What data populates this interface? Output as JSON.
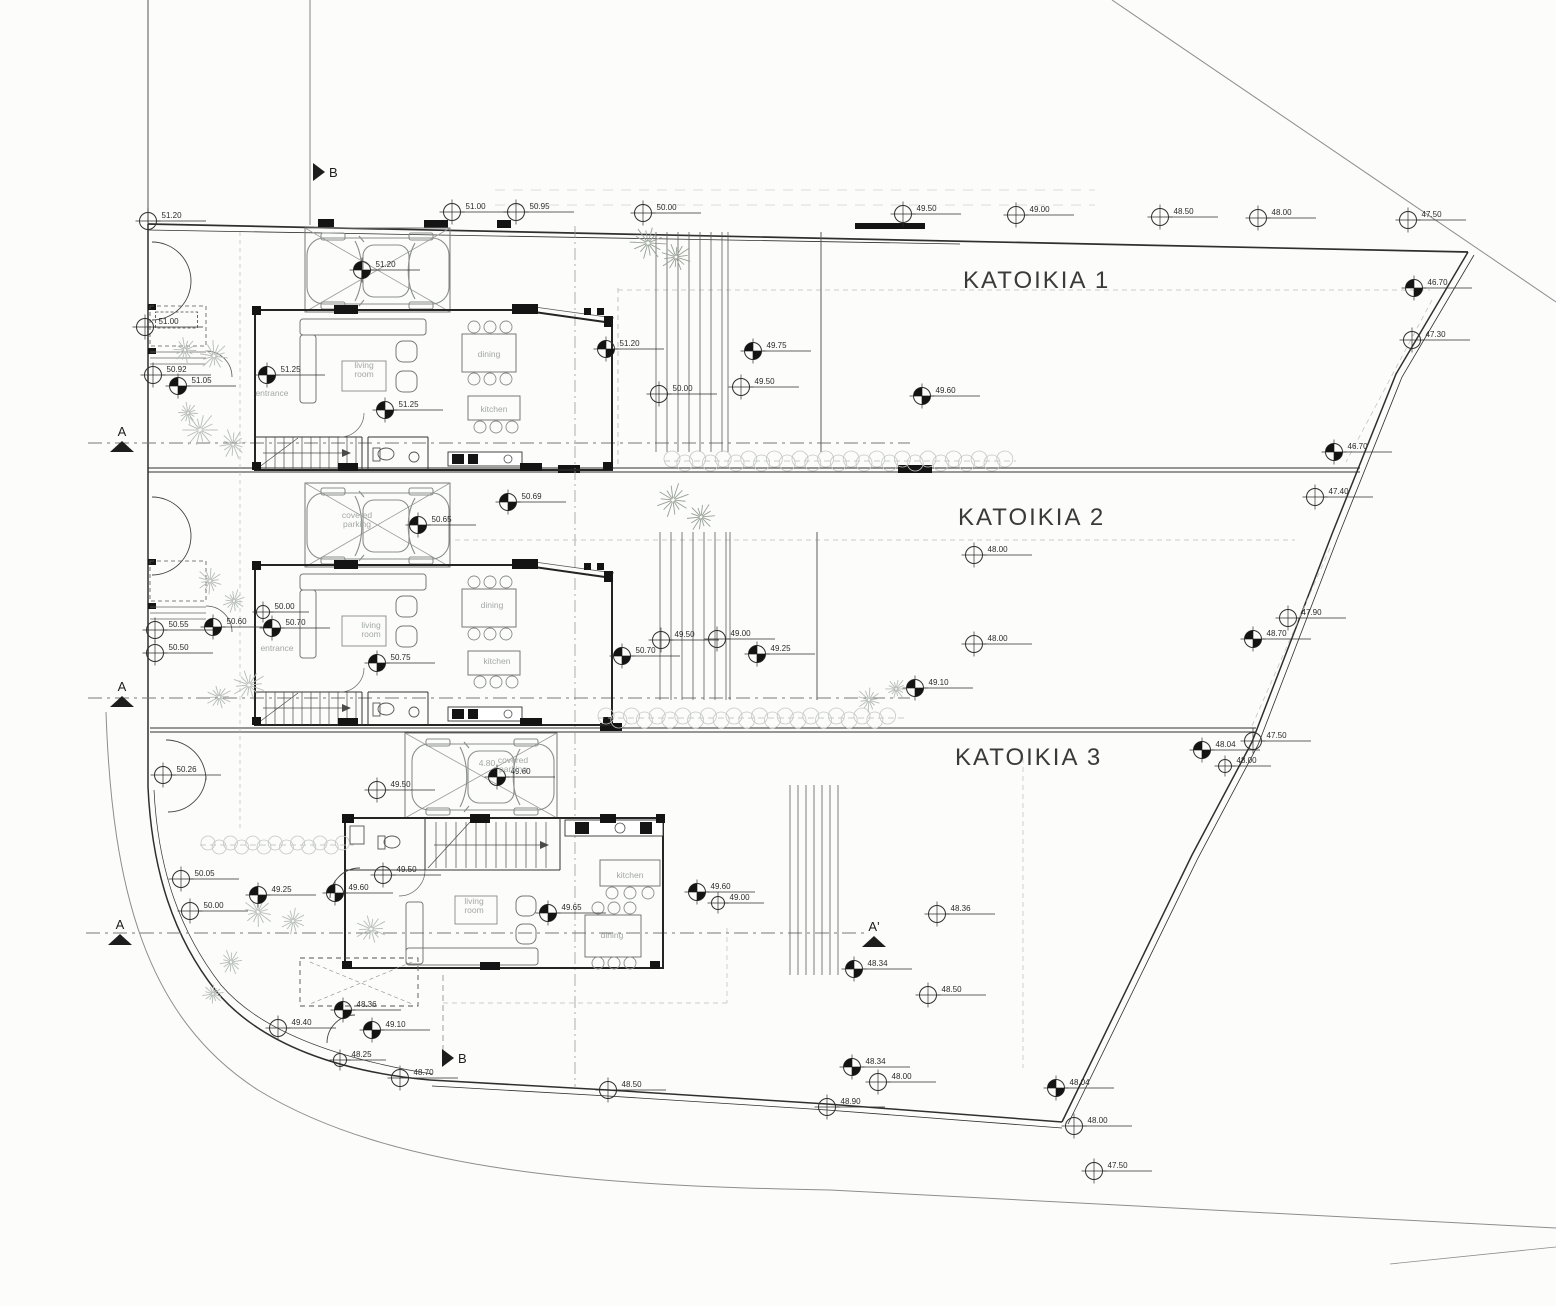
{
  "drawing": {
    "titles": [
      {
        "text": "KATOIKIA 1",
        "x": 963,
        "y": 288
      },
      {
        "text": "KATOIKIA 2",
        "x": 958,
        "y": 525
      },
      {
        "text": "KATOIKIA 3",
        "x": 955,
        "y": 765
      }
    ],
    "section_markers": [
      {
        "label": "B",
        "x": 313,
        "y": 172,
        "dir": "r"
      },
      {
        "label": "B",
        "x": 442,
        "y": 1058,
        "dir": "r"
      },
      {
        "label": "A",
        "x": 122,
        "y": 447,
        "dir": "u"
      },
      {
        "label": "A",
        "x": 122,
        "y": 702,
        "dir": "u"
      },
      {
        "label": "A",
        "x": 120,
        "y": 940,
        "dir": "u"
      },
      {
        "label": "A'",
        "x": 874,
        "y": 942,
        "dir": "u"
      }
    ],
    "room_labels": [
      {
        "t": "living",
        "t2": "room",
        "x": 364,
        "y": 368
      },
      {
        "t": "dining",
        "x": 489,
        "y": 357
      },
      {
        "t": "kitchen",
        "x": 494,
        "y": 412
      },
      {
        "t": "entrance",
        "x": 272,
        "y": 396,
        "size": 7.5
      },
      {
        "t": "covered",
        "t2": "parking",
        "x": 357,
        "y": 518
      },
      {
        "t": "living",
        "t2": "room",
        "x": 371,
        "y": 628
      },
      {
        "t": "dining",
        "x": 492,
        "y": 608
      },
      {
        "t": "kitchen",
        "x": 497,
        "y": 664
      },
      {
        "t": "entrance",
        "x": 277,
        "y": 651,
        "size": 7.5
      },
      {
        "t": "covered",
        "t2": "parking",
        "x": 513,
        "y": 763
      },
      {
        "t": "living",
        "t2": "room",
        "x": 474,
        "y": 904
      },
      {
        "t": "kitchen",
        "x": 630,
        "y": 878
      },
      {
        "t": "dining",
        "x": 612,
        "y": 938
      }
    ],
    "misc_labels": [
      {
        "t": "4.80",
        "x": 487,
        "y": 766,
        "size": 8,
        "dark": 1
      }
    ],
    "elevation_markers": [
      {
        "x": 148,
        "y": 221,
        "v": "51.20"
      },
      {
        "x": 452,
        "y": 212,
        "v": "51.00"
      },
      {
        "x": 516,
        "y": 212,
        "v": "50.95"
      },
      {
        "x": 643,
        "y": 213,
        "v": "50.00"
      },
      {
        "x": 903,
        "y": 214,
        "v": "49.50"
      },
      {
        "x": 1016,
        "y": 215,
        "v": "49.00"
      },
      {
        "x": 1160,
        "y": 217,
        "v": "48.50"
      },
      {
        "x": 1258,
        "y": 218,
        "v": "48.00"
      },
      {
        "x": 1408,
        "y": 220,
        "v": "47.50"
      },
      {
        "x": 1414,
        "y": 288,
        "v": "46.70",
        "h": 1
      },
      {
        "x": 1412,
        "y": 340,
        "v": "47.30"
      },
      {
        "x": 362,
        "y": 270,
        "v": "51.20",
        "h": 1
      },
      {
        "x": 145,
        "y": 327,
        "v": "51.00",
        "box": 1
      },
      {
        "x": 153,
        "y": 375,
        "v": "50.92"
      },
      {
        "x": 178,
        "y": 386,
        "v": "51.05",
        "h": 1
      },
      {
        "x": 267,
        "y": 375,
        "v": "51.25",
        "h": 1
      },
      {
        "x": 385,
        "y": 410,
        "v": "51.25",
        "h": 1
      },
      {
        "x": 606,
        "y": 349,
        "v": "51.20",
        "h": 1
      },
      {
        "x": 753,
        "y": 351,
        "v": "49.75",
        "h": 1
      },
      {
        "x": 741,
        "y": 387,
        "v": "49.50"
      },
      {
        "x": 659,
        "y": 394,
        "v": "50.00"
      },
      {
        "x": 922,
        "y": 396,
        "v": "49.60",
        "h": 1
      },
      {
        "x": 1334,
        "y": 452,
        "v": "46.70",
        "h": 1
      },
      {
        "x": 1315,
        "y": 497,
        "v": "47.40"
      },
      {
        "x": 418,
        "y": 525,
        "v": "50.65",
        "h": 1
      },
      {
        "x": 508,
        "y": 502,
        "v": "50.69",
        "h": 1
      },
      {
        "x": 155,
        "y": 630,
        "v": "50.55"
      },
      {
        "x": 155,
        "y": 653,
        "v": "50.50"
      },
      {
        "x": 213,
        "y": 627,
        "v": "50.60",
        "h": 1
      },
      {
        "x": 263,
        "y": 612,
        "v": "50.00",
        "s": 1
      },
      {
        "x": 272,
        "y": 628,
        "v": "50.70",
        "h": 1
      },
      {
        "x": 377,
        "y": 663,
        "v": "50.75",
        "h": 1
      },
      {
        "x": 622,
        "y": 656,
        "v": "50.70",
        "h": 1
      },
      {
        "x": 661,
        "y": 640,
        "v": "49.50"
      },
      {
        "x": 717,
        "y": 639,
        "v": "49.00"
      },
      {
        "x": 757,
        "y": 654,
        "v": "49.25",
        "h": 1
      },
      {
        "x": 974,
        "y": 555,
        "v": "48.00"
      },
      {
        "x": 974,
        "y": 644,
        "v": "48.00"
      },
      {
        "x": 915,
        "y": 688,
        "v": "49.10",
        "h": 1
      },
      {
        "x": 1288,
        "y": 618,
        "v": "47.90"
      },
      {
        "x": 1253,
        "y": 639,
        "v": "48.70",
        "h": 1
      },
      {
        "x": 1253,
        "y": 741,
        "v": "47.50"
      },
      {
        "x": 1202,
        "y": 750,
        "v": "48.04",
        "h": 1
      },
      {
        "x": 1225,
        "y": 766,
        "v": "48.00",
        "s": 1
      },
      {
        "x": 163,
        "y": 775,
        "v": "50.26"
      },
      {
        "x": 181,
        "y": 879,
        "v": "50.05"
      },
      {
        "x": 190,
        "y": 911,
        "v": "50.00"
      },
      {
        "x": 377,
        "y": 790,
        "v": "49.50"
      },
      {
        "x": 497,
        "y": 777,
        "v": "49.60",
        "h": 1
      },
      {
        "x": 258,
        "y": 895,
        "v": "49.25",
        "h": 1
      },
      {
        "x": 335,
        "y": 893,
        "v": "49.60",
        "h": 1
      },
      {
        "x": 383,
        "y": 875,
        "v": "49.50"
      },
      {
        "x": 548,
        "y": 913,
        "v": "49.65",
        "h": 1
      },
      {
        "x": 697,
        "y": 892,
        "v": "49.60",
        "h": 1
      },
      {
        "x": 718,
        "y": 903,
        "v": "49.00",
        "s": 1
      },
      {
        "x": 937,
        "y": 914,
        "v": "48.36"
      },
      {
        "x": 854,
        "y": 969,
        "v": "48.34",
        "h": 1
      },
      {
        "x": 928,
        "y": 995,
        "v": "48.50"
      },
      {
        "x": 852,
        "y": 1067,
        "v": "48.34",
        "h": 1
      },
      {
        "x": 878,
        "y": 1082,
        "v": "48.00"
      },
      {
        "x": 1056,
        "y": 1088,
        "v": "48.04",
        "h": 1
      },
      {
        "x": 1074,
        "y": 1126,
        "v": "48.00"
      },
      {
        "x": 1094,
        "y": 1171,
        "v": "47.50"
      },
      {
        "x": 343,
        "y": 1010,
        "v": "48.36",
        "h": 1
      },
      {
        "x": 372,
        "y": 1030,
        "v": "49.10",
        "h": 1
      },
      {
        "x": 340,
        "y": 1060,
        "v": "48.25",
        "s": 1
      },
      {
        "x": 400,
        "y": 1078,
        "v": "48.70"
      },
      {
        "x": 608,
        "y": 1090,
        "v": "48.50"
      },
      {
        "x": 827,
        "y": 1107,
        "v": "48.90"
      },
      {
        "x": 278,
        "y": 1028,
        "v": "49.40"
      }
    ],
    "trees": [
      {
        "x": 648,
        "y": 243,
        "r": 20,
        "d": 1
      },
      {
        "x": 676,
        "y": 257,
        "r": 17,
        "d": 1
      },
      {
        "x": 185,
        "y": 350,
        "r": 14
      },
      {
        "x": 214,
        "y": 356,
        "r": 17
      },
      {
        "x": 200,
        "y": 430,
        "r": 21
      },
      {
        "x": 233,
        "y": 444,
        "r": 17
      },
      {
        "x": 188,
        "y": 413,
        "r": 12
      },
      {
        "x": 210,
        "y": 581,
        "r": 15
      },
      {
        "x": 234,
        "y": 601,
        "r": 13
      },
      {
        "x": 249,
        "y": 685,
        "r": 19
      },
      {
        "x": 219,
        "y": 697,
        "r": 14
      },
      {
        "x": 673,
        "y": 500,
        "r": 19,
        "d": 1
      },
      {
        "x": 701,
        "y": 517,
        "r": 16,
        "d": 1
      },
      {
        "x": 869,
        "y": 700,
        "r": 14
      },
      {
        "x": 896,
        "y": 689,
        "r": 12
      },
      {
        "x": 258,
        "y": 912,
        "r": 17
      },
      {
        "x": 293,
        "y": 921,
        "r": 15
      },
      {
        "x": 371,
        "y": 929,
        "r": 17
      },
      {
        "x": 231,
        "y": 962,
        "r": 14
      },
      {
        "x": 213,
        "y": 994,
        "r": 12
      }
    ],
    "hedges": [
      {
        "x1": 672,
        "x2": 1008,
        "y": 461,
        "r": 8
      },
      {
        "x1": 606,
        "x2": 900,
        "y": 718,
        "r": 8
      },
      {
        "x1": 208,
        "x2": 346,
        "y": 845,
        "r": 7
      }
    ],
    "colors": {
      "paper": "#fcfcfa",
      "ink": "#2f2f2f",
      "light": "#8f8f8f",
      "faint": "#c4c8c4",
      "tree": "#b6bcb6",
      "tree_dark": "#97a097",
      "label": "#a2a8a6",
      "black": "#141414"
    }
  }
}
